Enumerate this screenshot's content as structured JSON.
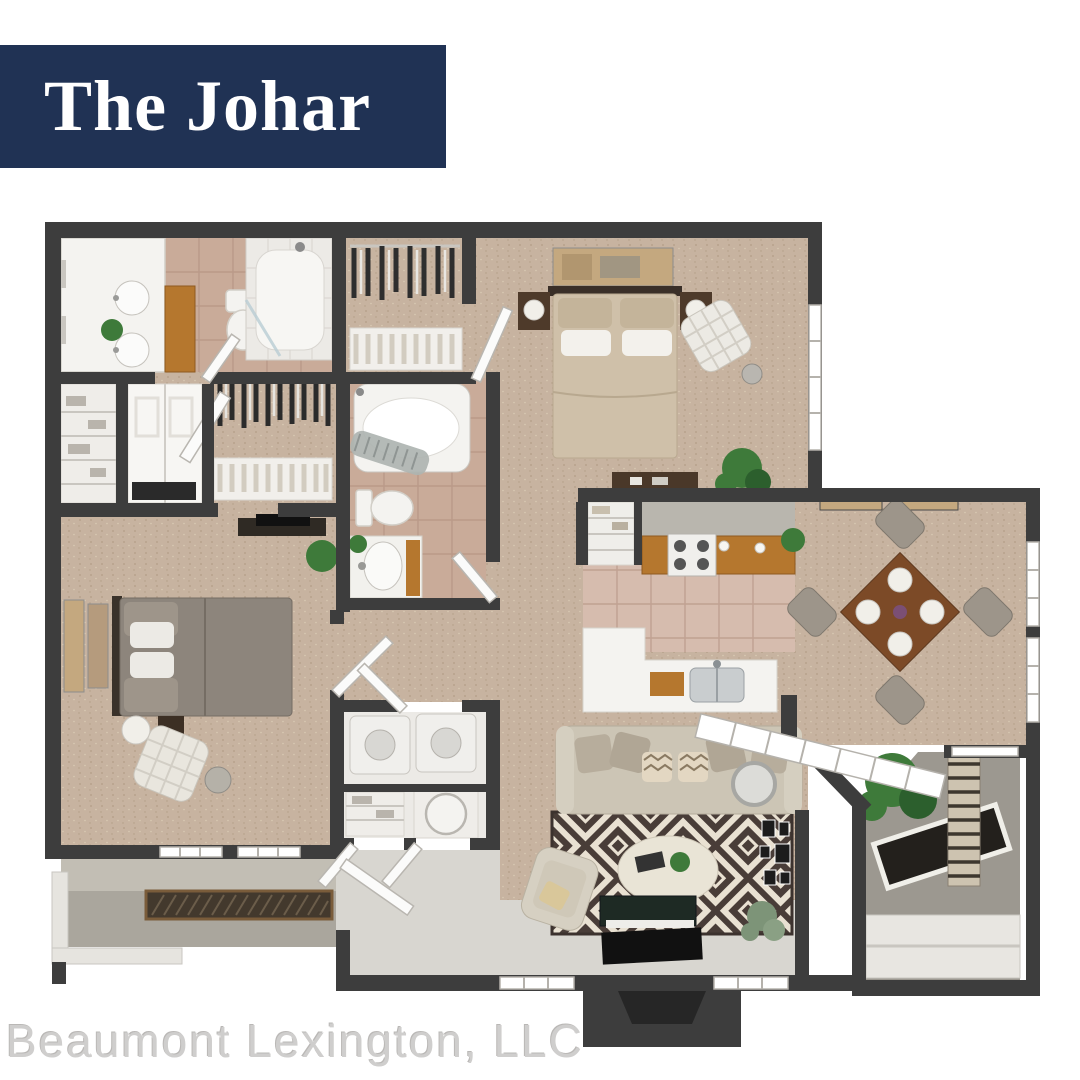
{
  "banner": {
    "title": "The Johar"
  },
  "footer": {
    "company": "Beaumont Lexington, LLC"
  },
  "colors": {
    "banner_bg": "#203254",
    "banner_text": "#ffffff",
    "footer_text": "#cfcecd",
    "wall": "#3d3d3d",
    "carpet": "#c7b3a0",
    "carpet_dot1": "#b29d86",
    "carpet_dot2": "#d9cab4",
    "tile_bath": "#c9ab99",
    "tile_line": "#b08f7e",
    "tile_kitchen": "#d6bcae",
    "fixture": "#f4f3f0",
    "floor_gray": "#d8d6d0",
    "concrete": "#aaa69d",
    "balcony": "#9c9890",
    "wood": "#b5772e",
    "wood_dark": "#7c4a27",
    "rug_dark": "#493d38",
    "rug_cream": "#e9e1d2",
    "sofa": "#ccc5b5",
    "bed_tan": "#cfc0a9",
    "bed_gray": "#8d857c",
    "plant": "#3e7a3a",
    "plant_dark": "#2c5f2d",
    "appliance": "#f0efec",
    "grate": "#43392d",
    "tv": "#111111",
    "stoop_inner": "#262626",
    "chair_gray": "#9d958a",
    "art_tan": "#c4a87f"
  },
  "floorplan": {
    "areas": [
      "master bathroom",
      "walk-in closet",
      "master bedroom",
      "linen closet",
      "bedroom closet",
      "second walk-in closet",
      "hall bathroom",
      "hallway",
      "bedroom 2",
      "kitchen",
      "pantry",
      "dining room",
      "living room",
      "laundry closet",
      "storage closets",
      "entry",
      "front patio",
      "balcony",
      "outdoor storage"
    ]
  }
}
